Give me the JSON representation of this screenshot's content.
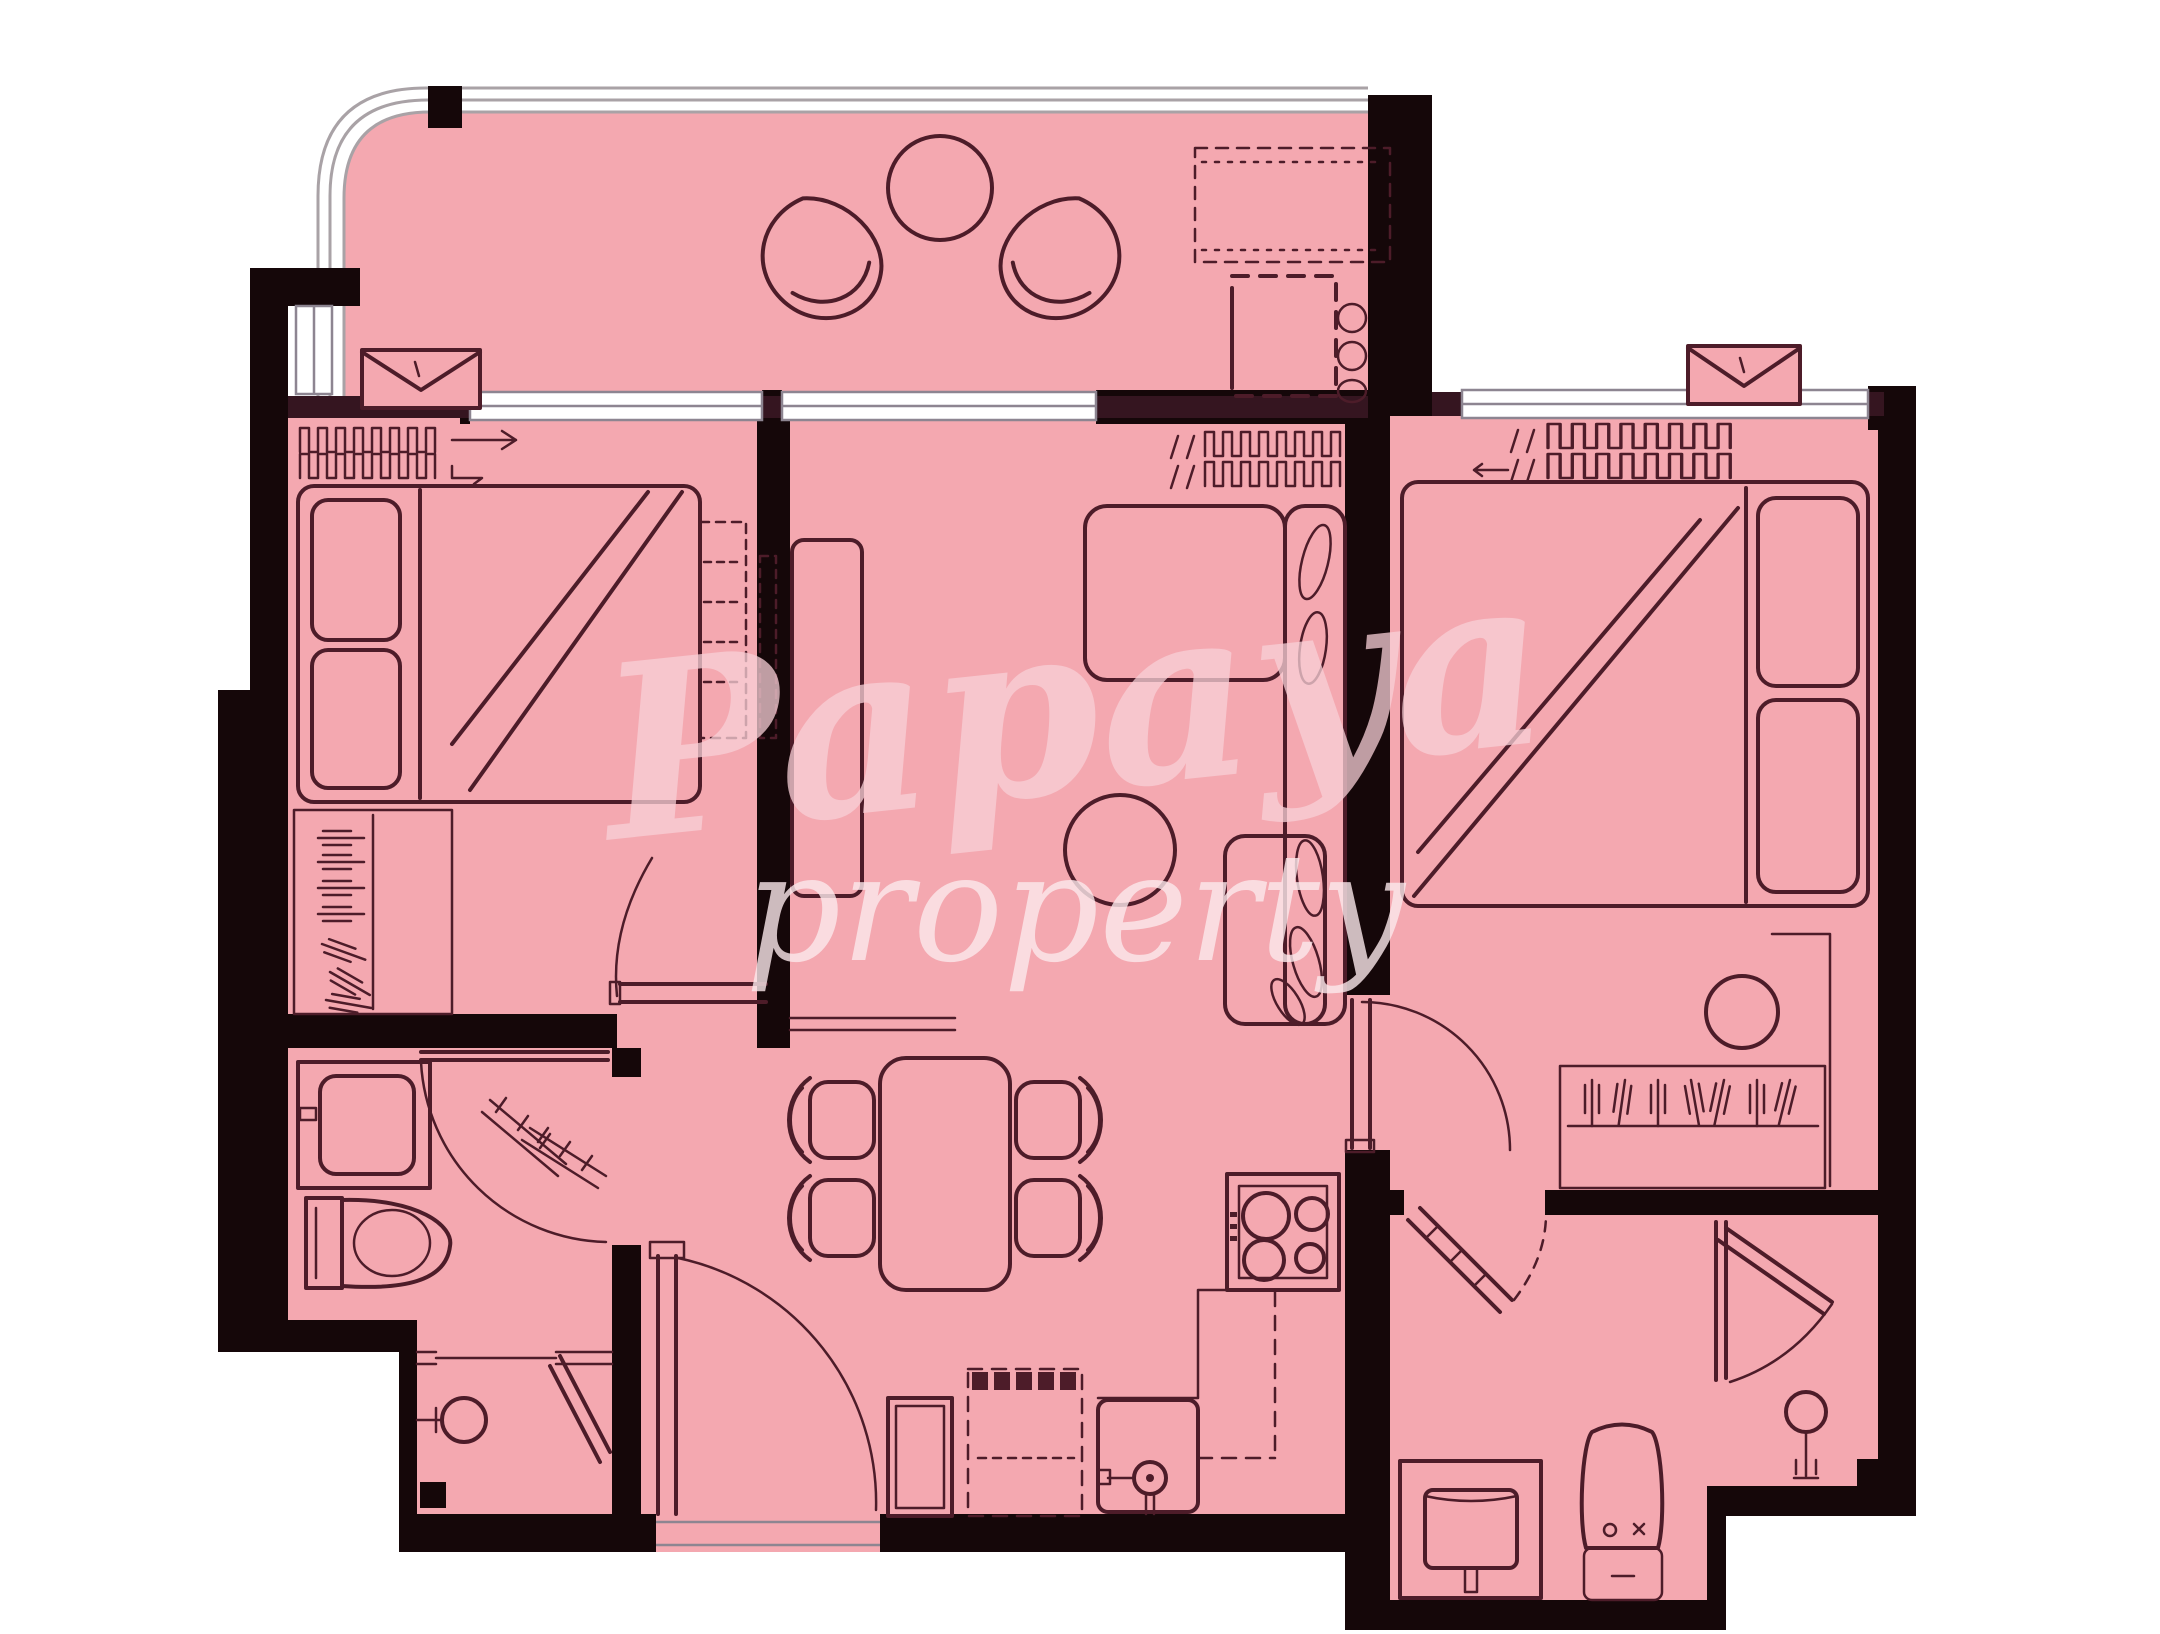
{
  "title": "Two-bedroom apartment floor plan",
  "watermark": {
    "line1": "Papaya",
    "line2": "property"
  },
  "colors": {
    "background": "#ffffff",
    "floor": "#f4a8b0",
    "walls": "#150709",
    "sill": "#351520",
    "furniture_line": "#4d1c29",
    "window_frame": "#a9a2a6",
    "watermark_primary": "#f8d0d7",
    "watermark_secondary": "#fce9ec"
  }
}
